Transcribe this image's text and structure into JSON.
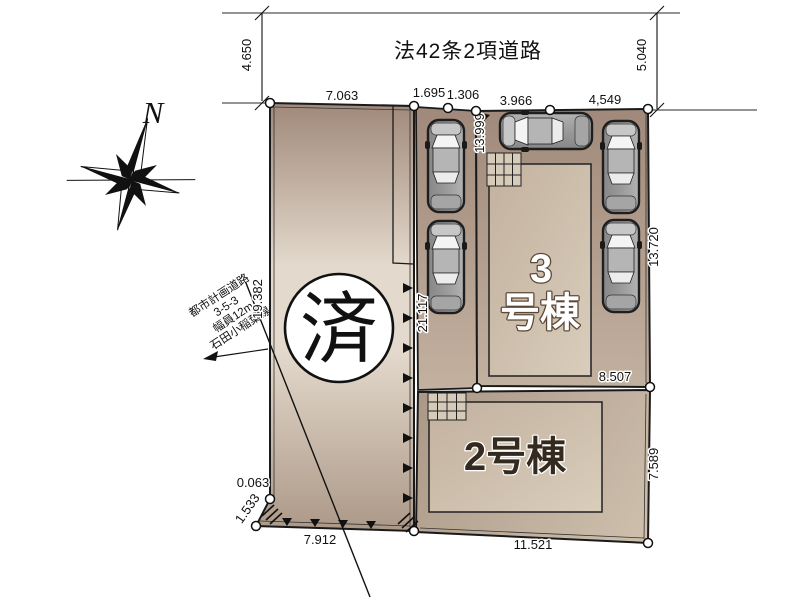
{
  "road": {
    "label": "法42条2項道路",
    "dim_left": "4.650",
    "dim_right": "5.040"
  },
  "top_dims": [
    "7.063",
    "1.695",
    "1.306",
    "3.966",
    "4,549"
  ],
  "dims": {
    "left_edge": "19.382",
    "boundary": "21.117",
    "parking_edge": "13.999",
    "right_upper": "13.720",
    "right_lower": "7.589",
    "bldg3_parcel_bottom": "8.507",
    "bottom_left": "7.912",
    "bottom_right": "11.521",
    "corner_sliver": "0.063",
    "corner_diag": "1.533"
  },
  "planned_road": {
    "lines": [
      "都市計画道路",
      "3-5-3",
      "幅員12m",
      "石田小稲葉線"
    ]
  },
  "marks": {
    "sold": "済",
    "compass": "N"
  },
  "buildings": {
    "b3_number": "3",
    "b3_suffix": "号棟",
    "b2_label": "2号棟"
  },
  "colors": {
    "ground_dark": "#a0897a",
    "ground_light": "#e3d9cc",
    "ground_mid": "#c3b1a0",
    "ground_low": "#ac9887",
    "parcel2_dark": "#ab9887",
    "parcel2_light": "#cfc0ae",
    "building_dark": "#c2b19e",
    "building_light": "#d9cdbb",
    "outline": "#1a1a1a",
    "car_body": "#9a9a9a"
  }
}
